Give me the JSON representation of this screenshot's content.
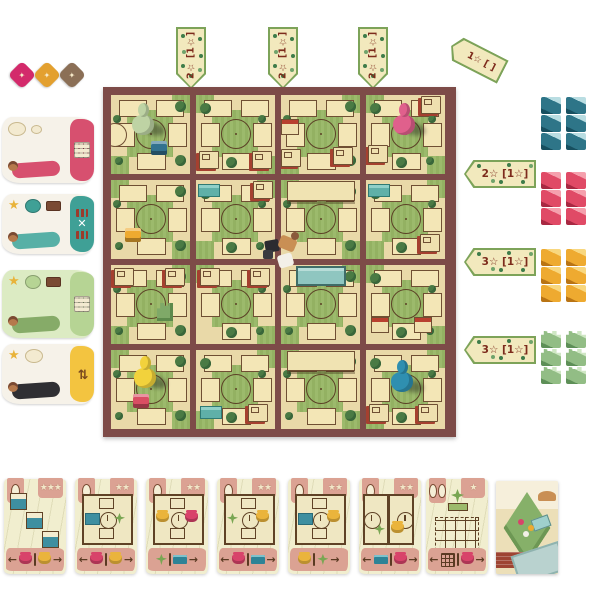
{
  "scene": "garden-board-game-tabletop",
  "tokens": [
    {
      "name": "pink-token",
      "color": "#d32a6b",
      "glyph": "✦"
    },
    {
      "name": "yellow-token",
      "color": "#e3a02f",
      "glyph": "✦"
    },
    {
      "name": "brown-token",
      "color": "#8b6f56",
      "glyph": "✦"
    }
  ],
  "top_banners": [
    {
      "label": "2☆ [1☆]"
    },
    {
      "label": "2☆ [1☆]"
    },
    {
      "label": "2☆ [1☆]"
    }
  ],
  "corner_banner": {
    "label": "1☆ [ ]"
  },
  "right_banners": [
    {
      "label": "2☆ [1☆]"
    },
    {
      "label": "3☆ [1☆]"
    },
    {
      "label": "3☆ [1☆]"
    }
  ],
  "banner_colors": {
    "face": "#f2e9bd",
    "border": "#7da359",
    "text": "#7d2b1c",
    "dot": "#3e7c49"
  },
  "supplies": [
    {
      "name": "teal-blocks",
      "y": 97,
      "main": "#2e7588",
      "light": "#b9dde2",
      "dark": "#174f5f",
      "shape": "cube",
      "stacks": 2,
      "per_stack": 3
    },
    {
      "name": "pink-blocks",
      "y": 172,
      "main": "#e04a66",
      "light": "#f5a0ad",
      "dark": "#a82842",
      "shape": "cube",
      "stacks": 2,
      "per_stack": 3
    },
    {
      "name": "yellow-blocks",
      "y": 249,
      "main": "#eeaa30",
      "light": "#f8d77f",
      "dark": "#b97414",
      "shape": "cube",
      "stacks": 2,
      "per_stack": 3
    },
    {
      "name": "green-blocks",
      "y": 331,
      "main": "#92bd85",
      "light": "#cfe7c4",
      "dark": "#5d8f57",
      "shape": "tree",
      "stacks": 2,
      "per_stack": 3
    }
  ],
  "player_mats": [
    {
      "name": "pink-player-mat",
      "y": 117,
      "h": 66,
      "base": "#f6f2e9",
      "accent": "#d7506f",
      "fig": "#d7506f",
      "icons": [
        "bubble",
        "bubble-sm"
      ],
      "panel_icon": "grid"
    },
    {
      "name": "teal-player-mat",
      "y": 194,
      "h": 60,
      "base": "#f6f2e9",
      "accent": "#3fa096",
      "fig": "#57b0a6",
      "icons": [
        "star",
        "badge",
        "chip"
      ],
      "panel_icon": "dots-x"
    },
    {
      "name": "green-player-mat",
      "y": 270,
      "h": 68,
      "base": "#dcebc3",
      "accent": "#b6d494",
      "fig": "#86ab68",
      "icons": [
        "star",
        "badge",
        "chip"
      ],
      "panel_icon": "grid"
    },
    {
      "name": "yellow-player-mat",
      "y": 344,
      "h": 60,
      "base": "#f6f2e9",
      "accent": "#f3c440",
      "fig": "#2f2f33",
      "icons": [
        "star",
        "bubble"
      ],
      "panel_icon": "swap"
    }
  ],
  "board": {
    "bg": "#7d4b48",
    "tile_base": "#e9d9a8",
    "grass": "#9cba6c",
    "pawn_colors": {
      "green": "#bed3a4",
      "pink": "#e0608c",
      "yellow": "#f2d23c",
      "teal": "#2f8fb0"
    },
    "block_colors": {
      "blue": "#33728f",
      "yellow": "#eeaa30",
      "pinkblk": "#d94f63"
    },
    "tiles": [
      {
        "r": 0,
        "c": 0,
        "pieces": [
          {
            "t": "circplot",
            "x": -8,
            "y": 28
          },
          {
            "t": "pawn",
            "c": "green",
            "x": 20,
            "y": 8
          },
          {
            "t": "blockp",
            "c": "blue",
            "x": 40,
            "y": 46
          }
        ]
      },
      {
        "r": 0,
        "c": 1,
        "pieces": [
          {
            "t": "crate",
            "x": 3,
            "y": 56
          },
          {
            "t": "crate",
            "x": 56,
            "y": 56
          }
        ]
      },
      {
        "r": 0,
        "c": 2,
        "pieces": [
          {
            "t": "stand",
            "x": 0,
            "y": 24
          },
          {
            "t": "crate",
            "x": 0,
            "y": 54
          },
          {
            "t": "crate",
            "x": 52,
            "y": 52
          }
        ]
      },
      {
        "r": 0,
        "c": 3,
        "pieces": [
          {
            "t": "crate",
            "x": 55,
            "y": 1
          },
          {
            "t": "crate",
            "x": 2,
            "y": 50
          },
          {
            "t": "pawn",
            "c": "pink",
            "x": 26,
            "y": 8
          }
        ]
      },
      {
        "r": 1,
        "c": 0,
        "pieces": [
          {
            "t": "blockp",
            "c": "yellow",
            "x": 14,
            "y": 48
          }
        ]
      },
      {
        "r": 1,
        "c": 1,
        "pieces": [
          {
            "t": "shelf",
            "x": 2,
            "y": 4
          },
          {
            "t": "crate",
            "x": 57,
            "y": 1
          }
        ]
      },
      {
        "r": 1,
        "c": 2,
        "pieces": [
          {
            "t": "pavilion",
            "x": 6,
            "y": 1
          }
        ]
      },
      {
        "r": 1,
        "c": 3,
        "pieces": [
          {
            "t": "shelf",
            "x": 2,
            "y": 4
          },
          {
            "t": "crate",
            "x": 54,
            "y": 54
          }
        ]
      },
      {
        "r": 2,
        "c": 0,
        "pieces": [
          {
            "t": "crate",
            "x": 3,
            "y": 3
          },
          {
            "t": "crate",
            "x": 54,
            "y": 3
          },
          {
            "t": "treeblk",
            "x": 46,
            "y": 38
          }
        ]
      },
      {
        "r": 2,
        "c": 1,
        "pieces": [
          {
            "t": "crate",
            "x": 4,
            "y": 3
          },
          {
            "t": "crate",
            "x": 54,
            "y": 3
          }
        ]
      },
      {
        "r": 2,
        "c": 2,
        "pieces": [
          {
            "t": "pool",
            "x": 15,
            "y": 1
          }
        ]
      },
      {
        "r": 2,
        "c": 3,
        "pieces": [
          {
            "t": "stand",
            "x": 5,
            "y": 52
          },
          {
            "t": "stand",
            "x": 48,
            "y": 52
          }
        ]
      },
      {
        "r": 3,
        "c": 0,
        "pieces": [
          {
            "t": "pawn",
            "c": "yellow",
            "x": 22,
            "y": 6
          },
          {
            "t": "blockp",
            "c": "pinkblk",
            "x": 22,
            "y": 44
          }
        ]
      },
      {
        "r": 3,
        "c": 1,
        "pieces": [
          {
            "t": "shelf",
            "x": 4,
            "y": 56
          },
          {
            "t": "crate",
            "x": 52,
            "y": 54
          }
        ]
      },
      {
        "r": 3,
        "c": 2,
        "pieces": [
          {
            "t": "pavilion",
            "x": 6,
            "y": 1
          }
        ]
      },
      {
        "r": 3,
        "c": 3,
        "pieces": [
          {
            "t": "pawn",
            "c": "teal",
            "x": 24,
            "y": 10
          },
          {
            "t": "crate",
            "x": 3,
            "y": 54
          },
          {
            "t": "crate",
            "x": 52,
            "y": 54
          }
        ]
      }
    ]
  },
  "center_figure": {
    "name": "traveler-figure",
    "present": true
  },
  "cards": [
    {
      "name": "card-1",
      "x": 4,
      "gourds": 1,
      "stars": 3,
      "body": {
        "type": "pools"
      },
      "footer": [
        "arrow-left",
        "pot-pink",
        "divider",
        "pot-yellow",
        "arrow-right"
      ]
    },
    {
      "name": "card-2",
      "x": 75,
      "gourds": 1,
      "stars": 2,
      "body": {
        "type": "room",
        "left": "pool",
        "right": "plant"
      },
      "footer": [
        "arrow-left",
        "pot-pink",
        "divider",
        "pot-yellow",
        "arrow-right"
      ]
    },
    {
      "name": "card-3",
      "x": 146,
      "gourds": 1,
      "stars": 2,
      "body": {
        "type": "room",
        "left": "pot-yellow",
        "right": "pot-pink"
      },
      "footer": [
        "plant",
        "divider",
        "pool",
        "arrow-right"
      ]
    },
    {
      "name": "card-4",
      "x": 217,
      "gourds": 1,
      "stars": 2,
      "body": {
        "type": "room",
        "left": "plant",
        "right": "pot-yellow"
      },
      "footer": [
        "arrow-left",
        "pot-pink",
        "divider",
        "pool",
        "arrow-right"
      ]
    },
    {
      "name": "card-5",
      "x": 288,
      "gourds": 1,
      "stars": 2,
      "body": {
        "type": "room",
        "left": "pool",
        "right": "pot-yellow"
      },
      "footer": [
        "pot-yellow",
        "divider",
        "plant",
        "arrow-right"
      ]
    },
    {
      "name": "card-6",
      "x": 359,
      "gourds": 1,
      "stars": 2,
      "body": {
        "type": "roompair"
      },
      "footer": [
        "arrow-left",
        "pool",
        "divider",
        "pot-pink",
        "arrow-right"
      ]
    },
    {
      "name": "card-7",
      "x": 426,
      "gourds": 2,
      "stars": 1,
      "body": {
        "type": "gridplant"
      },
      "footer": [
        "arrow-left",
        "grid",
        "divider",
        "pot-pink",
        "arrow-right"
      ]
    }
  ],
  "art_card": {
    "name": "deck-art-card",
    "x": 496
  }
}
